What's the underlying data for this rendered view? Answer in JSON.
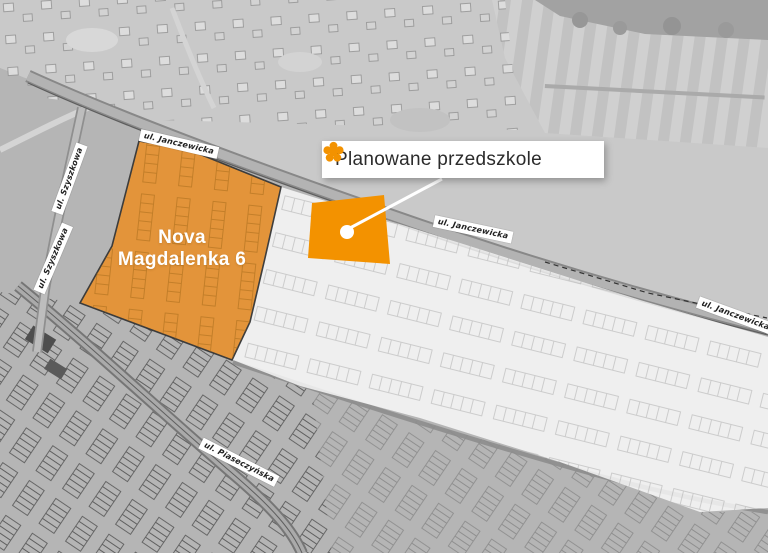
{
  "legend": {
    "label": "Planowane przedszkole"
  },
  "development": {
    "name": "Nova\nMagdalenka 6"
  },
  "streets": {
    "janczewicka_top": "ul. Janczewicka",
    "janczewicka_mid": "ul. Janczewicka",
    "janczewicka_right": "ul. Janczewicka",
    "szyszkowa_upper": "ul. Szyszkowa",
    "szyszkowa_lower": "ul. Szyszkowa",
    "piaseczynska": "ul. Piaseczyńska"
  },
  "colors": {
    "highlight_orange": "#E8912D",
    "kindergarten_orange": "#F39200",
    "label_text": "#2B2B2B"
  }
}
